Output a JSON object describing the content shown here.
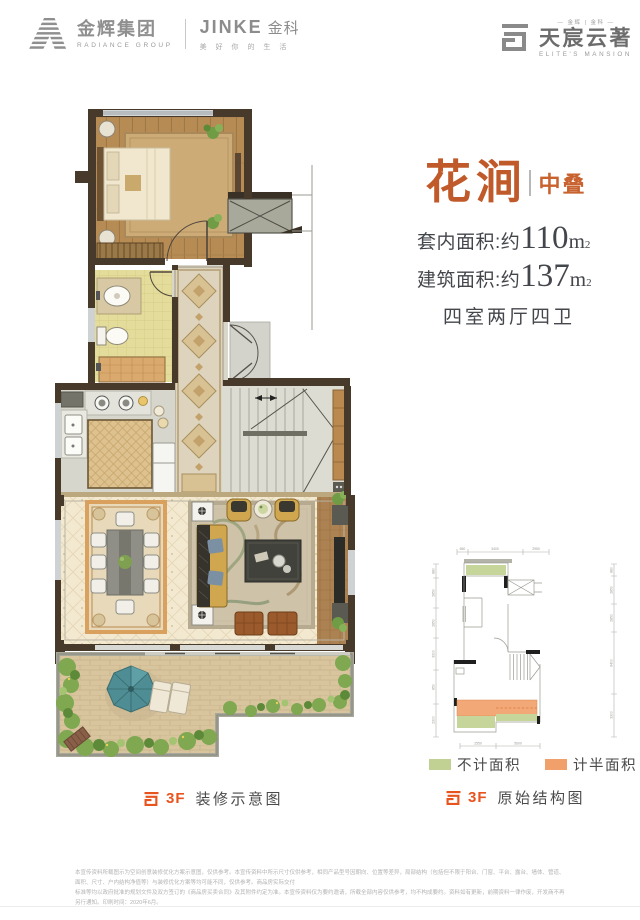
{
  "header": {
    "radiance_cn": "金辉集团",
    "radiance_en": "RADIANCE GROUP",
    "jinke_brand": "JINKE",
    "jinke_cn": "金科",
    "jinke_tagline": "美 好 你 的 生 活",
    "elite_top": "— 金辉 | 金科 —",
    "elite_cn": "天宸云著",
    "elite_en": "ELITE'S MANSION"
  },
  "info": {
    "title": "花涧",
    "tag": "中叠",
    "lines": [
      {
        "label": "套内面积:约",
        "value": "110",
        "unit": "m",
        "sup": "2"
      },
      {
        "label": "建筑面积:约",
        "value": "137",
        "unit": "m",
        "sup": "2"
      }
    ],
    "layout": "四室两厅四卫"
  },
  "legend": {
    "items": [
      {
        "label": "不计面积",
        "color": "#c0d193"
      },
      {
        "label": "计半面积",
        "color": "#f1a06b"
      }
    ]
  },
  "captions": {
    "left_floor": "3F",
    "left_text": "装修示意图",
    "right_floor": "3F",
    "right_text": "原始结构图"
  },
  "mini_dims": {
    "top": [
      "650",
      "3400",
      "2950"
    ],
    "left": [
      "880",
      "2850",
      "2850",
      "3300",
      "850",
      "2300"
    ],
    "right": [
      "880",
      "2850",
      "2850",
      "6400",
      "3300"
    ],
    "bottom": [
      "2550",
      "5600"
    ]
  },
  "disclaimer": {
    "line1": "本宣传资料所载图示为空间创意装修优化方案示意图，仅供参考。本宣传资料中所示尺寸仅供参考，相同产品型号因朝向、位置等差异，局部结构（包括但不限于阳台、门窗、平台、露台、墙体、管道、面积、尺寸、户内结构净值等）与装修优化方案等均可能不同，仅供参考。商品房实际交付",
    "line2": "标准等均以政府批准的规划文件及双方签订的《商品房买卖合同》及其附件约定为准。本宣传资料仅为要约邀请，所载全部内容仅供参考，均不构成要约。资料如有更新，前期资料一律作废，开发商不再另行通知。印刷时间：2020年6月。"
  },
  "colors": {
    "accent_orange": "#c05a2a",
    "caption_orange": "#e8541e",
    "legend_green": "#c0d193",
    "legend_orange": "#f1a06b",
    "text_dark": "#3f4247",
    "logo_gray": "#8f8f8f",
    "wall_brown": "#473a2b"
  }
}
